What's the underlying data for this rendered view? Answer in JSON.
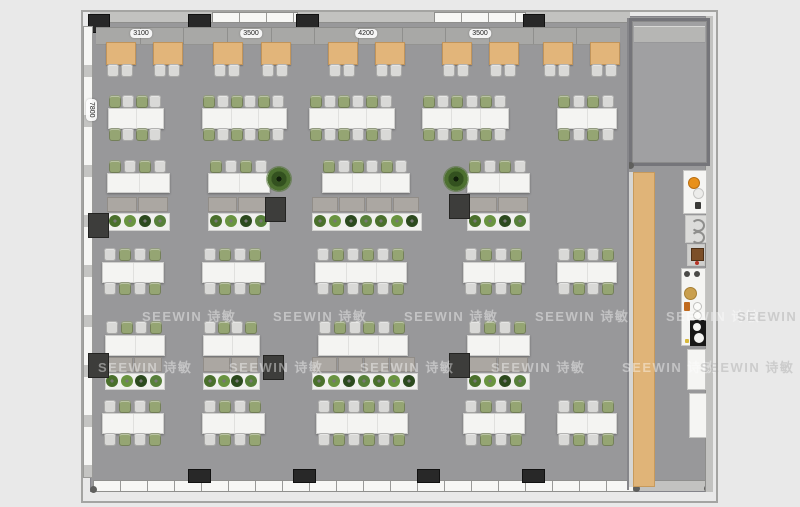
{
  "watermark": {
    "text": "SEEWIN 诗敏"
  },
  "labels": {
    "top": [
      {
        "text": "3100",
        "cx": 141
      },
      {
        "text": "3500",
        "cx": 251
      },
      {
        "text": "4200",
        "cx": 366
      },
      {
        "text": "3500",
        "cx": 480
      }
    ],
    "left": {
      "text": "7800"
    }
  },
  "colors": {
    "floor": "#98989a",
    "chair_green": "#95a573",
    "chair_white": "#d9d9d7",
    "booth_wood": "#e2b57a",
    "bar_wood": "#e0b478",
    "table_white": "#f4f4f2",
    "pillar": "#282828"
  },
  "floorplan": {
    "booth_row": {
      "bench": {
        "x": 96,
        "y": 27,
        "w": 524,
        "h": 16,
        "seams": 11
      },
      "table_y": 42,
      "table_w": 28,
      "table_h": 21,
      "chair_y": 64,
      "tables": [
        {
          "x": 106
        },
        {
          "x": 153
        },
        {
          "x": 213
        },
        {
          "x": 261
        },
        {
          "x": 328
        },
        {
          "x": 375
        },
        {
          "x": 442
        },
        {
          "x": 489
        },
        {
          "x": 543
        },
        {
          "x": 590
        }
      ]
    },
    "dining_rows": [
      {
        "name": "row-b",
        "chair_top_y": 95,
        "table_y": 108,
        "table_h": 19,
        "chair_bottom_y": 128,
        "start": "green",
        "tables": [
          {
            "x": 108,
            "w": 54,
            "n": 4
          },
          {
            "x": 202,
            "w": 83,
            "n": 6
          },
          {
            "x": 309,
            "w": 84,
            "n": 6
          },
          {
            "x": 422,
            "w": 85,
            "n": 6
          },
          {
            "x": 557,
            "w": 58,
            "n": 4
          }
        ]
      },
      {
        "name": "row-d",
        "chair_top_y": 248,
        "table_y": 262,
        "table_h": 19,
        "chair_bottom_y": 282,
        "start": "white",
        "tables": [
          {
            "x": 102,
            "w": 60,
            "n": 4
          },
          {
            "x": 202,
            "w": 61,
            "n": 4
          },
          {
            "x": 315,
            "w": 90,
            "n": 6
          },
          {
            "x": 463,
            "w": 60,
            "n": 4
          },
          {
            "x": 557,
            "w": 58,
            "n": 4
          }
        ]
      },
      {
        "name": "row-f",
        "chair_top_y": 400,
        "table_y": 413,
        "table_h": 19,
        "chair_bottom_y": 433,
        "start": "white",
        "tables": [
          {
            "x": 102,
            "w": 60,
            "n": 4
          },
          {
            "x": 202,
            "w": 61,
            "n": 4
          },
          {
            "x": 316,
            "w": 90,
            "n": 6
          },
          {
            "x": 463,
            "w": 60,
            "n": 4
          },
          {
            "x": 557,
            "w": 58,
            "n": 4
          }
        ]
      }
    ],
    "lounge_rows": [
      {
        "name": "row-c",
        "chair_y": 160,
        "table_y": 173,
        "table_h": 18,
        "bench_y": 197,
        "bench_h": 15,
        "planter_y": 213,
        "planter_h": 16,
        "start": "green",
        "groups": [
          {
            "tx": 107,
            "tw": 61,
            "n": 4,
            "bx": 107,
            "bw": 61,
            "m": 2,
            "p": 4
          },
          {
            "tx": 208,
            "tw": 60,
            "n": 4,
            "bx": 208,
            "bw": 60,
            "m": 2,
            "p": 4
          },
          {
            "tx": 322,
            "tw": 86,
            "n": 6,
            "bx": 312,
            "bw": 108,
            "m": 4,
            "p": 7
          },
          {
            "tx": 467,
            "tw": 61,
            "n": 4,
            "bx": 467,
            "bw": 61,
            "m": 2,
            "p": 4
          }
        ]
      },
      {
        "name": "row-e",
        "chair_y": 321,
        "table_y": 335,
        "table_h": 19,
        "bench_y": 357,
        "bench_h": 15,
        "planter_y": 373,
        "planter_h": 15,
        "start": "white",
        "groups": [
          {
            "tx": 105,
            "tw": 58,
            "n": 4,
            "bx": 105,
            "bw": 58,
            "m": 2,
            "p": 4
          },
          {
            "tx": 203,
            "tw": 55,
            "n": 4,
            "bx": 203,
            "bw": 55,
            "m": 2,
            "p": 4
          },
          {
            "tx": 318,
            "tw": 88,
            "n": 6,
            "bx": 312,
            "bw": 104,
            "m": 4,
            "p": 7
          },
          {
            "tx": 467,
            "tw": 61,
            "n": 4,
            "bx": 467,
            "bw": 61,
            "m": 2,
            "p": 4
          }
        ]
      }
    ],
    "cubes": [
      {
        "x": 88,
        "y": 213
      },
      {
        "x": 265,
        "y": 197
      },
      {
        "x": 449,
        "y": 194
      },
      {
        "x": 88,
        "y": 353
      },
      {
        "x": 263,
        "y": 355
      },
      {
        "x": 449,
        "y": 353
      }
    ],
    "trees": [
      {
        "x": 266,
        "y": 166
      },
      {
        "x": 443,
        "y": 166
      }
    ],
    "plant_colors": [
      "#4a702c",
      "#699440",
      "#2c4a1e",
      "#57803a"
    ],
    "watermark_rows": [
      {
        "y": 306,
        "xs": [
          142,
          273,
          404,
          535,
          666,
          737
        ]
      },
      {
        "y": 357,
        "xs": [
          98,
          229,
          360,
          491,
          622,
          700
        ]
      }
    ]
  }
}
